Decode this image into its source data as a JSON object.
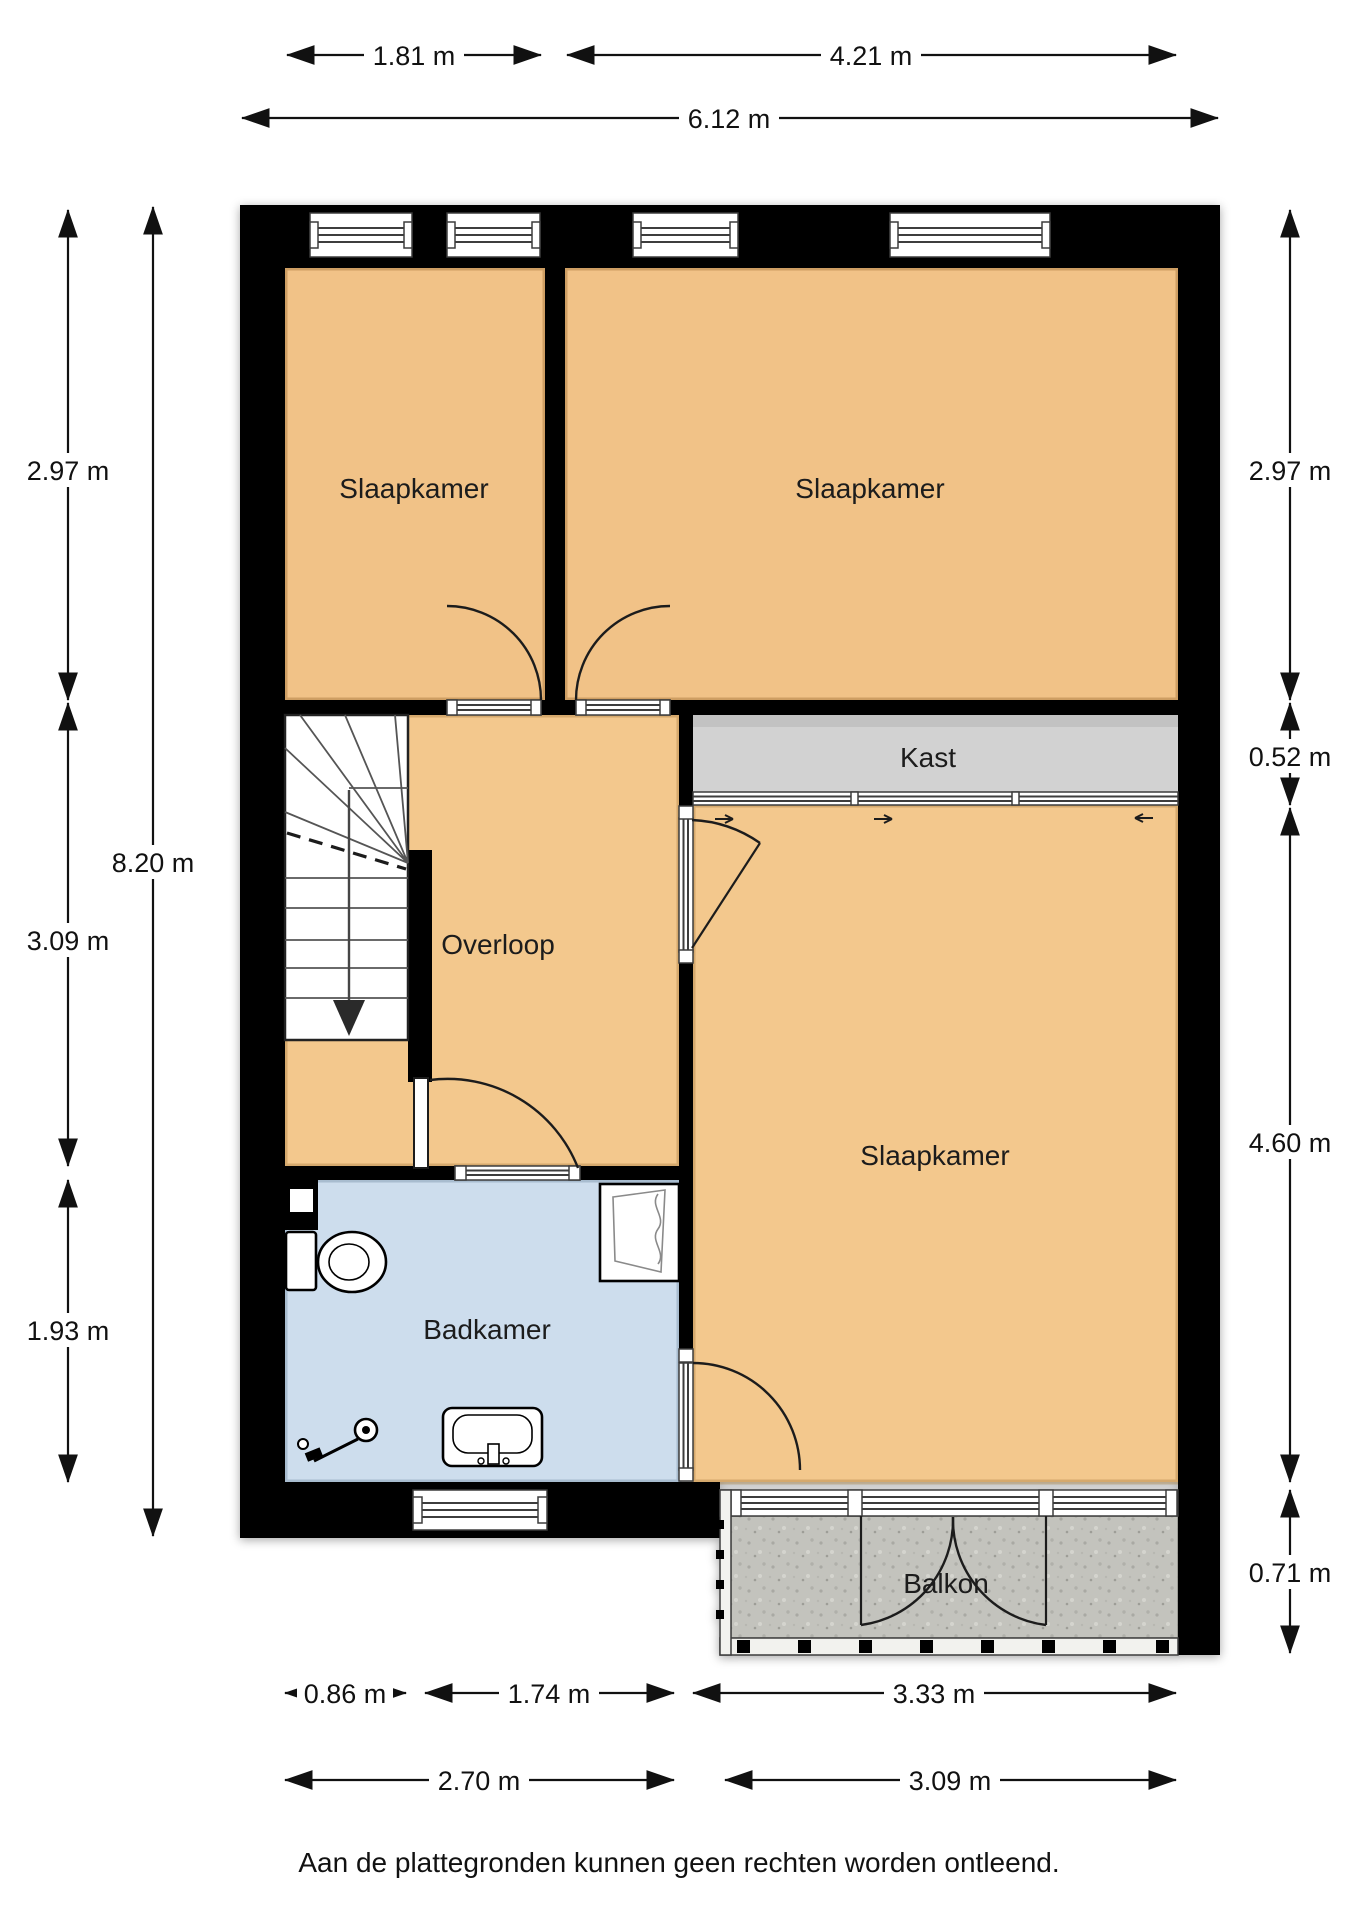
{
  "plan": {
    "rooms": {
      "slaapkamer_left": {
        "label": "Slaapkamer"
      },
      "slaapkamer_right": {
        "label": "Slaapkamer"
      },
      "slaapkamer_large": {
        "label": "Slaapkamer"
      },
      "kast": {
        "label": "Kast"
      },
      "overloop": {
        "label": "Overloop"
      },
      "badkamer": {
        "label": "Badkamer"
      },
      "balkon": {
        "label": "Balkon"
      }
    },
    "fixtures": [
      "stairs-down",
      "toilet",
      "shower",
      "hand-shower",
      "sink",
      "sliding-closet-doors"
    ],
    "colors": {
      "floor_orange": "#f1c287",
      "kast_gray": "#d2d2d2",
      "badkamer_blue": "#cddded",
      "balkon_concrete": "#c3c3bd",
      "wall_black": "#000000"
    }
  },
  "dimensions": {
    "top": {
      "d1": "1.81 m",
      "d2": "4.21 m",
      "total": "6.12 m"
    },
    "left": {
      "a": "2.97 m",
      "b": "3.09 m",
      "c": "1.93 m",
      "total": "8.20 m"
    },
    "right": {
      "a": "2.97 m",
      "b": "0.52 m",
      "c": "4.60 m",
      "d": "0.71 m"
    },
    "bottom": {
      "row1": [
        "0.86 m",
        "1.74 m",
        "3.33 m"
      ],
      "row2": [
        "2.70 m",
        "3.09 m"
      ]
    }
  },
  "footer": {
    "disclaimer": "Aan de plattegronden kunnen geen rechten worden ontleend."
  }
}
